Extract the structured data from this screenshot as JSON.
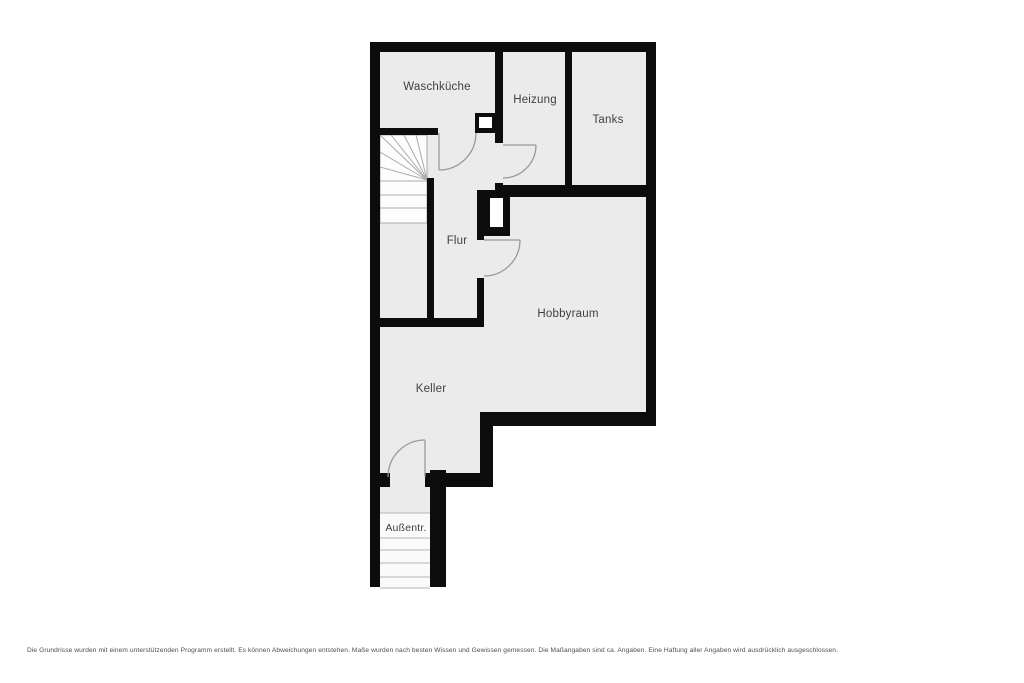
{
  "plan": {
    "title": "Kellergeschoss Grundriss",
    "rooms": [
      {
        "id": "waschkueche",
        "label": "Waschküche"
      },
      {
        "id": "heizung",
        "label": "Heizung"
      },
      {
        "id": "tanks",
        "label": "Tanks"
      },
      {
        "id": "flur",
        "label": "Flur"
      },
      {
        "id": "hobbyraum",
        "label": "Hobbyraum"
      },
      {
        "id": "keller",
        "label": "Keller"
      },
      {
        "id": "aussentr",
        "label": "Außentr."
      }
    ],
    "features": [
      "staircase-winder",
      "exterior-entrance-stairs",
      "chimney-flue-upper",
      "chimney-flue-lower",
      "door-waschkueche",
      "door-heizung",
      "door-hobbyraum",
      "door-keller-exterior"
    ]
  },
  "disclaimer": "Die Grundrisse wurden mit einem unterstützenden Programm erstellt. Es können Abweichungen entstehen. Maße wurden nach besten Wissen und Gewissen gemessen. Die Maßangaben sind ca. Angaben. Eine Haftung aller Angaben wird ausdrücklich ausgeschlossen.",
  "colors": {
    "wall": "#0c0c0c",
    "floor": "#ebebeb",
    "stair_fill": "#fdfdfd",
    "stair_line": "#aaaaaa",
    "door_line": "#999999",
    "label_text": "#3f3f3f",
    "background": "#ffffff"
  }
}
